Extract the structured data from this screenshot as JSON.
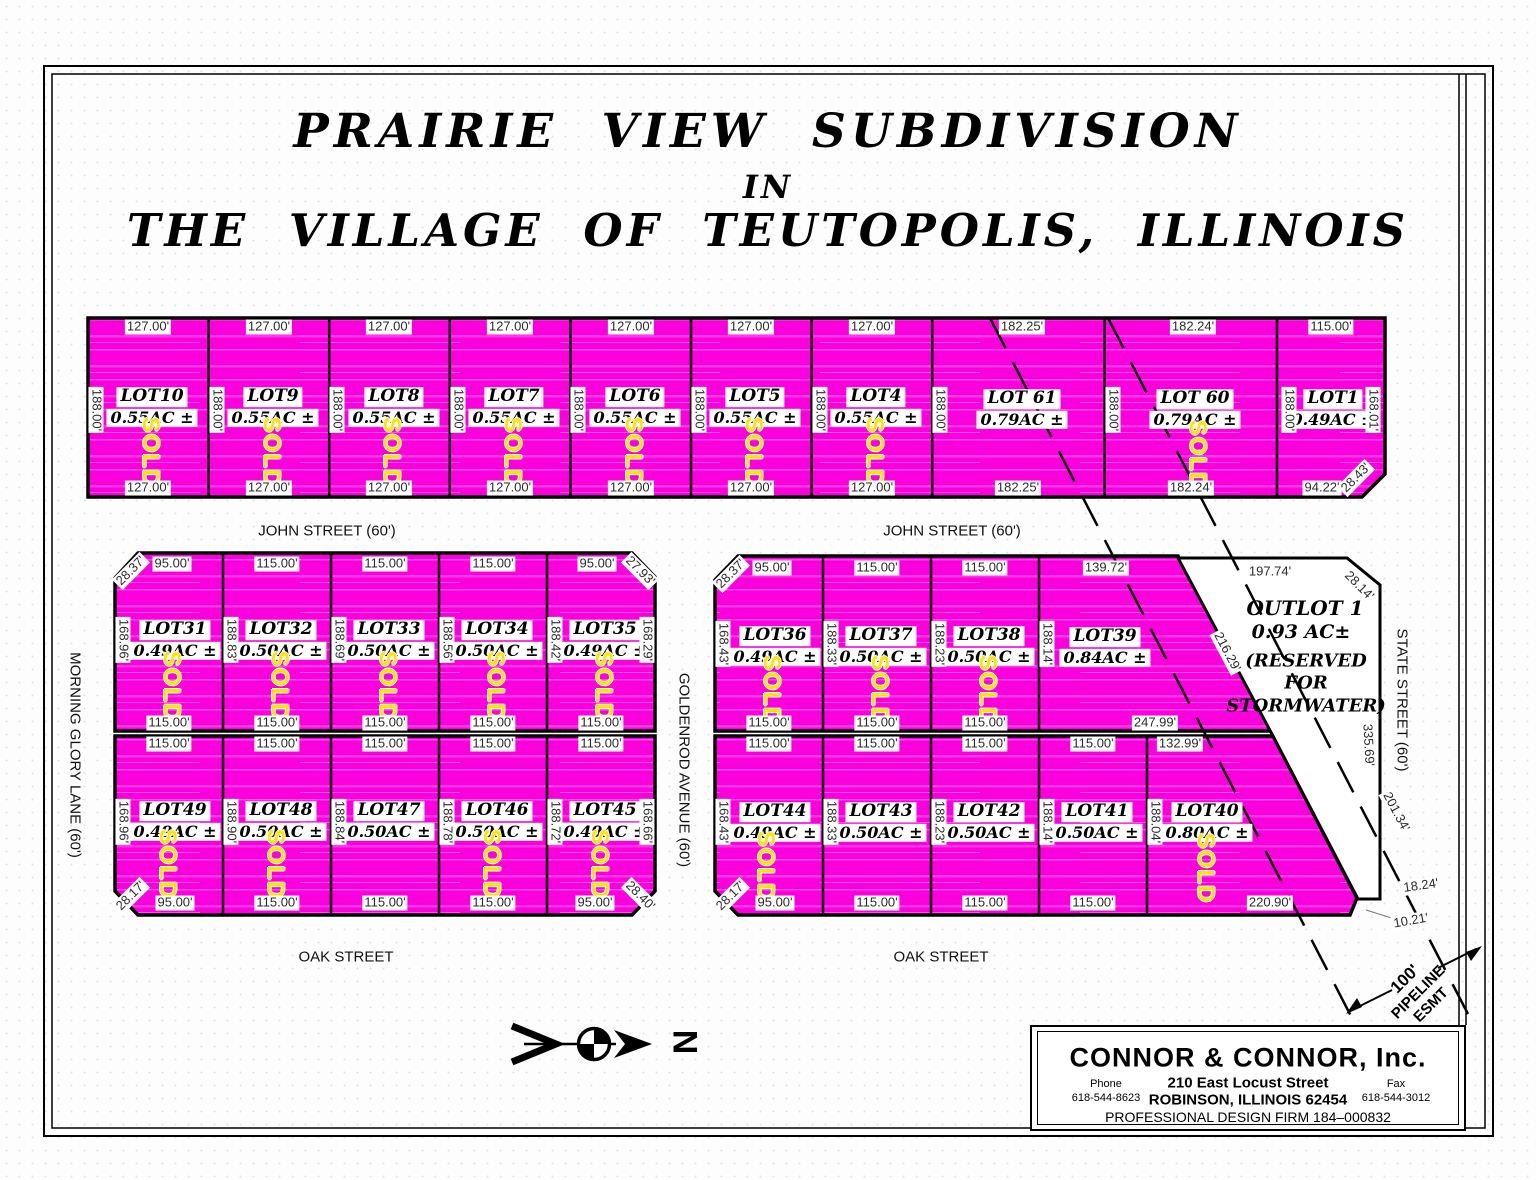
{
  "title": {
    "line1": "PRAIRIE  VIEW  SUBDIVISION",
    "line2": "IN",
    "line3": "THE  VILLAGE  OF  TEUTOPOLIS,  ILLINOIS"
  },
  "streets": {
    "john_left": "JOHN STREET (60')",
    "john_right": "JOHN STREET (60')",
    "oak_left": "OAK STREET",
    "oak_right": "OAK STREET",
    "morning_glory": "MORNING GLORY LANE  (60')",
    "goldenrod": "GOLDENROD AVENUE  (60')",
    "state": "STATE STREET  (60')"
  },
  "north": {
    "label": "N"
  },
  "sold_label": "SOLD",
  "pipeline": {
    "line1": "100'",
    "line2": "PIPELINE",
    "line3": "ESMT"
  },
  "outlot": {
    "name": "OUTLOT 1",
    "area": "0.93 AC±",
    "note_line1": "(RESERVED",
    "note_line2": "FOR",
    "note_line3": "STORMWATER)",
    "dims": [
      {
        "t": "197.74'",
        "x": 1270,
        "y": 572
      },
      {
        "t": "28.14'",
        "x": 1359,
        "y": 586,
        "r": 45
      },
      {
        "t": "335.69'",
        "x": 1368,
        "y": 745,
        "r": 87
      },
      {
        "t": "10.21'",
        "x": 1411,
        "y": 921,
        "r": -10
      }
    ]
  },
  "lots": [
    {
      "name": "LOT10",
      "area": "0.55AC ±",
      "sold": true,
      "label": [
        152,
        397
      ],
      "sold_pos": [
        150,
        452
      ],
      "dims": [
        {
          "t": "127.00'",
          "x": 148,
          "y": 327
        },
        {
          "t": "127.00'",
          "x": 148,
          "y": 488
        },
        {
          "t": "188.00'",
          "x": 96,
          "y": 410,
          "r": 90
        }
      ]
    },
    {
      "name": "LOT9",
      "area": "0.55AC ±",
      "sold": true,
      "label": [
        273,
        397
      ],
      "sold_pos": [
        271,
        452
      ],
      "dims": [
        {
          "t": "127.00'",
          "x": 269,
          "y": 327
        },
        {
          "t": "127.00'",
          "x": 269,
          "y": 488
        },
        {
          "t": "188.00'",
          "x": 217,
          "y": 410,
          "r": 90
        }
      ]
    },
    {
      "name": "LOT8",
      "area": "0.55AC ±",
      "sold": true,
      "label": [
        394,
        397
      ],
      "sold_pos": [
        391,
        452
      ],
      "dims": [
        {
          "t": "127.00'",
          "x": 389,
          "y": 327
        },
        {
          "t": "127.00'",
          "x": 389,
          "y": 488
        },
        {
          "t": "188.00'",
          "x": 337,
          "y": 410,
          "r": 90
        }
      ]
    },
    {
      "name": "LOT7",
      "area": "0.55AC ±",
      "sold": true,
      "label": [
        514,
        397
      ],
      "sold_pos": [
        512,
        452
      ],
      "dims": [
        {
          "t": "127.00'",
          "x": 510,
          "y": 327
        },
        {
          "t": "127.00'",
          "x": 510,
          "y": 488
        },
        {
          "t": "188.00'",
          "x": 458,
          "y": 410,
          "r": 90
        }
      ]
    },
    {
      "name": "LOT6",
      "area": "0.55AC ±",
      "sold": true,
      "label": [
        635,
        397
      ],
      "sold_pos": [
        633,
        452
      ],
      "dims": [
        {
          "t": "127.00'",
          "x": 631,
          "y": 327
        },
        {
          "t": "127.00'",
          "x": 631,
          "y": 488
        },
        {
          "t": "188.00'",
          "x": 578,
          "y": 410,
          "r": 90
        }
      ]
    },
    {
      "name": "LOT5",
      "area": "0.55AC ±",
      "sold": true,
      "label": [
        755,
        397
      ],
      "sold_pos": [
        753,
        452
      ],
      "dims": [
        {
          "t": "127.00'",
          "x": 751,
          "y": 327
        },
        {
          "t": "127.00'",
          "x": 751,
          "y": 488
        },
        {
          "t": "188.00'",
          "x": 699,
          "y": 410,
          "r": 90
        }
      ]
    },
    {
      "name": "LOT4",
      "area": "0.55AC ±",
      "sold": true,
      "label": [
        876,
        397
      ],
      "sold_pos": [
        874,
        452
      ],
      "dims": [
        {
          "t": "127.00'",
          "x": 872,
          "y": 327
        },
        {
          "t": "127.00'",
          "x": 872,
          "y": 488
        },
        {
          "t": "188.00'",
          "x": 820,
          "y": 410,
          "r": 90
        }
      ]
    },
    {
      "name": "LOT 61",
      "area": "0.79AC ±",
      "sold": false,
      "label": [
        1022,
        399
      ],
      "sold_pos": [
        0,
        0
      ],
      "dims": [
        {
          "t": "182.25'",
          "x": 1022,
          "y": 327
        },
        {
          "t": "182.25'",
          "x": 1018,
          "y": 488
        },
        {
          "t": "188.00'",
          "x": 940,
          "y": 410,
          "r": 90
        }
      ]
    },
    {
      "name": "LOT 60",
      "area": "0.79AC ±",
      "sold": true,
      "label": [
        1195,
        399
      ],
      "sold_pos": [
        1197,
        455
      ],
      "dims": [
        {
          "t": "182.24'",
          "x": 1193,
          "y": 327
        },
        {
          "t": "182.24'",
          "x": 1191,
          "y": 488
        },
        {
          "t": "188.00'",
          "x": 1113,
          "y": 410,
          "r": 90
        }
      ]
    },
    {
      "name": "LOT1",
      "area": "0.49AC ±",
      "sold": false,
      "label": [
        1333,
        399
      ],
      "sold_pos": [
        0,
        0
      ],
      "dims": [
        {
          "t": "115.00'",
          "x": 1331,
          "y": 327
        },
        {
          "t": "188.00'",
          "x": 1289,
          "y": 410,
          "r": 90
        },
        {
          "t": "168.01'",
          "x": 1373,
          "y": 410,
          "r": 90
        },
        {
          "t": "94.22'",
          "x": 1322,
          "y": 488
        },
        {
          "t": "28.43'",
          "x": 1356,
          "y": 478,
          "r": -45
        }
      ]
    },
    {
      "name": "LOT31",
      "area": "0.49AC ±",
      "sold": true,
      "label": [
        175,
        630
      ],
      "sold_pos": [
        171,
        686
      ],
      "dims": [
        {
          "t": "95.00'",
          "x": 172,
          "y": 564
        },
        {
          "t": "28.37'",
          "x": 131,
          "y": 571,
          "r": -45
        },
        {
          "t": "168.96'",
          "x": 123,
          "y": 640,
          "r": 90
        },
        {
          "t": "115.00'",
          "x": 169,
          "y": 723
        }
      ]
    },
    {
      "name": "LOT32",
      "area": "0.50AC ±",
      "sold": true,
      "label": [
        281,
        630
      ],
      "sold_pos": [
        279,
        686
      ],
      "dims": [
        {
          "t": "115.00'",
          "x": 277,
          "y": 564
        },
        {
          "t": "188.83'",
          "x": 231,
          "y": 640,
          "r": 90
        },
        {
          "t": "115.00'",
          "x": 277,
          "y": 723
        }
      ]
    },
    {
      "name": "LOT33",
      "area": "0.50AC ±",
      "sold": true,
      "label": [
        389,
        630
      ],
      "sold_pos": [
        387,
        686
      ],
      "dims": [
        {
          "t": "115.00'",
          "x": 385,
          "y": 564
        },
        {
          "t": "188.69'",
          "x": 339,
          "y": 640,
          "r": 90
        },
        {
          "t": "115.00'",
          "x": 385,
          "y": 723
        }
      ]
    },
    {
      "name": "LOT34",
      "area": "0.50AC ±",
      "sold": true,
      "label": [
        497,
        630
      ],
      "sold_pos": [
        495,
        686
      ],
      "dims": [
        {
          "t": "115.00'",
          "x": 493,
          "y": 564
        },
        {
          "t": "188.56'",
          "x": 447,
          "y": 640,
          "r": 90
        },
        {
          "t": "115.00'",
          "x": 493,
          "y": 723
        }
      ]
    },
    {
      "name": "LOT35",
      "area": "0.49AC ±",
      "sold": true,
      "label": [
        605,
        630
      ],
      "sold_pos": [
        603,
        686
      ],
      "dims": [
        {
          "t": "95.00'",
          "x": 597,
          "y": 564
        },
        {
          "t": "27.93'",
          "x": 640,
          "y": 571,
          "r": 45
        },
        {
          "t": "188.42'",
          "x": 555,
          "y": 640,
          "r": 90
        },
        {
          "t": "168.29'",
          "x": 647,
          "y": 640,
          "r": 90
        },
        {
          "t": "115.00'",
          "x": 601,
          "y": 723
        }
      ]
    },
    {
      "name": "LOT36",
      "area": "0.49AC ±",
      "sold": true,
      "label": [
        775,
        636
      ],
      "sold_pos": [
        771,
        690
      ],
      "dims": [
        {
          "t": "95.00'",
          "x": 772,
          "y": 568
        },
        {
          "t": "28.37'",
          "x": 731,
          "y": 574,
          "r": -45
        },
        {
          "t": "168.43'",
          "x": 723,
          "y": 644,
          "r": 90
        },
        {
          "t": "115.00'",
          "x": 769,
          "y": 723
        }
      ]
    },
    {
      "name": "LOT37",
      "area": "0.50AC ±",
      "sold": true,
      "label": [
        881,
        636
      ],
      "sold_pos": [
        879,
        690
      ],
      "dims": [
        {
          "t": "115.00'",
          "x": 877,
          "y": 568
        },
        {
          "t": "188.33'",
          "x": 831,
          "y": 644,
          "r": 90
        },
        {
          "t": "115.00'",
          "x": 877,
          "y": 723
        }
      ]
    },
    {
      "name": "LOT38",
      "area": "0.50AC ±",
      "sold": true,
      "label": [
        989,
        636
      ],
      "sold_pos": [
        987,
        690
      ],
      "dims": [
        {
          "t": "115.00'",
          "x": 985,
          "y": 568
        },
        {
          "t": "188.23'",
          "x": 939,
          "y": 644,
          "r": 90
        },
        {
          "t": "115.00'",
          "x": 985,
          "y": 723
        }
      ]
    },
    {
      "name": "LOT39",
      "area": "0.84AC ±",
      "sold": false,
      "label": [
        1105,
        637
      ],
      "sold_pos": [
        0,
        0
      ],
      "dims": [
        {
          "t": "139.72'",
          "x": 1106,
          "y": 568
        },
        {
          "t": "188.14'",
          "x": 1047,
          "y": 644,
          "r": 90
        },
        {
          "t": "247.99'",
          "x": 1155,
          "y": 723
        },
        {
          "t": "216.29'",
          "x": 1227,
          "y": 652,
          "r": 62
        }
      ]
    },
    {
      "name": "LOT49",
      "area": "0.49AC ±",
      "sold": true,
      "label": [
        175,
        811
      ],
      "sold_pos": [
        167,
        864
      ],
      "dims": [
        {
          "t": "115.00'",
          "x": 169,
          "y": 744
        },
        {
          "t": "168.96'",
          "x": 123,
          "y": 822,
          "r": 90
        },
        {
          "t": "95.00'",
          "x": 175,
          "y": 903
        },
        {
          "t": "28.17'",
          "x": 131,
          "y": 896,
          "r": -45
        }
      ]
    },
    {
      "name": "LOT48",
      "area": "0.50AC ±",
      "sold": true,
      "label": [
        281,
        811
      ],
      "sold_pos": [
        275,
        864
      ],
      "dims": [
        {
          "t": "115.00'",
          "x": 277,
          "y": 744
        },
        {
          "t": "188.90'",
          "x": 231,
          "y": 822,
          "r": 90
        },
        {
          "t": "115.00'",
          "x": 277,
          "y": 903
        }
      ]
    },
    {
      "name": "LOT47",
      "area": "0.50AC ±",
      "sold": false,
      "label": [
        389,
        811
      ],
      "sold_pos": [
        0,
        0
      ],
      "dims": [
        {
          "t": "115.00'",
          "x": 385,
          "y": 744
        },
        {
          "t": "188.84'",
          "x": 339,
          "y": 822,
          "r": 90
        },
        {
          "t": "115.00'",
          "x": 385,
          "y": 903
        }
      ]
    },
    {
      "name": "LOT46",
      "area": "0.50AC ±",
      "sold": true,
      "label": [
        497,
        811
      ],
      "sold_pos": [
        491,
        864
      ],
      "dims": [
        {
          "t": "115.00'",
          "x": 493,
          "y": 744
        },
        {
          "t": "188.78'",
          "x": 447,
          "y": 822,
          "r": 90
        },
        {
          "t": "115.00'",
          "x": 493,
          "y": 903
        }
      ]
    },
    {
      "name": "LOT45",
      "area": "0.49AC ±",
      "sold": true,
      "label": [
        605,
        811
      ],
      "sold_pos": [
        599,
        864
      ],
      "dims": [
        {
          "t": "115.00'",
          "x": 601,
          "y": 744
        },
        {
          "t": "188.72'",
          "x": 555,
          "y": 822,
          "r": 90
        },
        {
          "t": "168.66'",
          "x": 647,
          "y": 822,
          "r": 90
        },
        {
          "t": "95.00'",
          "x": 595,
          "y": 903
        },
        {
          "t": "28.40'",
          "x": 640,
          "y": 896,
          "r": 45
        }
      ]
    },
    {
      "name": "LOT44",
      "area": "0.49AC ±",
      "sold": true,
      "label": [
        775,
        812
      ],
      "sold_pos": [
        765,
        866
      ],
      "dims": [
        {
          "t": "115.00'",
          "x": 769,
          "y": 744
        },
        {
          "t": "168.43'",
          "x": 723,
          "y": 822,
          "r": 90
        },
        {
          "t": "95.00'",
          "x": 775,
          "y": 903
        },
        {
          "t": "28.17'",
          "x": 731,
          "y": 896,
          "r": -45
        }
      ]
    },
    {
      "name": "LOT43",
      "area": "0.50AC ±",
      "sold": false,
      "label": [
        881,
        812
      ],
      "sold_pos": [
        0,
        0
      ],
      "dims": [
        {
          "t": "115.00'",
          "x": 877,
          "y": 744
        },
        {
          "t": "188.33'",
          "x": 831,
          "y": 822,
          "r": 90
        },
        {
          "t": "115.00'",
          "x": 877,
          "y": 903
        }
      ]
    },
    {
      "name": "LOT42",
      "area": "0.50AC ±",
      "sold": false,
      "label": [
        989,
        812
      ],
      "sold_pos": [
        0,
        0
      ],
      "dims": [
        {
          "t": "115.00'",
          "x": 985,
          "y": 744
        },
        {
          "t": "188.23'",
          "x": 939,
          "y": 822,
          "r": 90
        },
        {
          "t": "115.00'",
          "x": 985,
          "y": 903
        }
      ]
    },
    {
      "name": "LOT41",
      "area": "0.50AC ±",
      "sold": false,
      "label": [
        1097,
        812
      ],
      "sold_pos": [
        0,
        0
      ],
      "dims": [
        {
          "t": "115.00'",
          "x": 1093,
          "y": 744
        },
        {
          "t": "188.14'",
          "x": 1047,
          "y": 822,
          "r": 90
        },
        {
          "t": "115.00'",
          "x": 1093,
          "y": 903
        }
      ]
    },
    {
      "name": "LOT40",
      "area": "0.80AC ±",
      "sold": true,
      "label": [
        1207,
        812
      ],
      "sold_pos": [
        1205,
        868
      ],
      "dims": [
        {
          "t": "132.99'",
          "x": 1180,
          "y": 744
        },
        {
          "t": "188.04'",
          "x": 1155,
          "y": 822,
          "r": 90
        },
        {
          "t": "220.90'",
          "x": 1270,
          "y": 903
        },
        {
          "t": "18.24'",
          "x": 1421,
          "y": 886,
          "r": -8
        },
        {
          "t": "201.34'",
          "x": 1396,
          "y": 812,
          "r": 62
        }
      ]
    }
  ],
  "company": {
    "name": "CONNOR  &  CONNOR,  Inc.",
    "phone_label": "Phone",
    "phone": "618-544-8623",
    "address1": "210  East  Locust  Street",
    "address2": "ROBINSON,  ILLINOIS  62454",
    "fax_label": "Fax",
    "fax": "618-544-3012",
    "firm": "PROFESSIONAL  DESIGN  FIRM  184–000832"
  }
}
